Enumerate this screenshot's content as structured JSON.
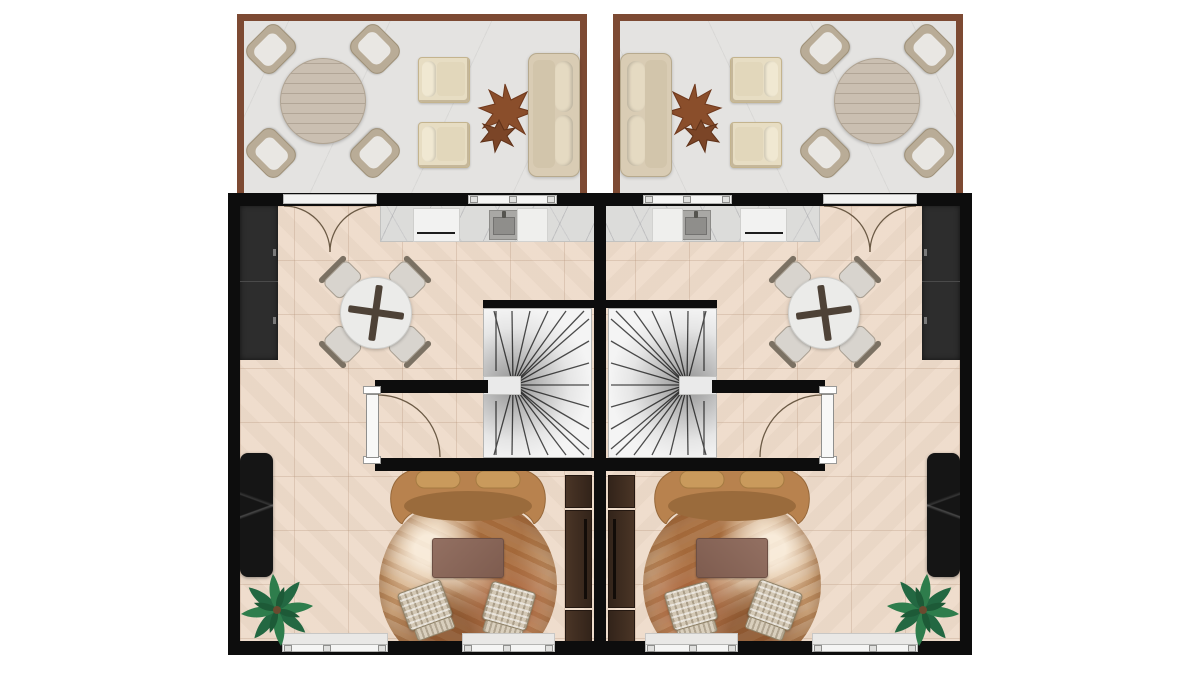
{
  "scene": {
    "type": "architectural-floor-plan",
    "view": "top-down 2D rendered plan",
    "description": "Two mirrored residential units (duplex) sharing a central party wall, each with a front terrace, kitchen-dining area, winder staircase and living room",
    "units": [
      "unit-left",
      "unit-right"
    ],
    "terraces": [
      "terrace-left",
      "terrace-right"
    ],
    "mirrored": true
  },
  "palette": {
    "background": "#ffffff",
    "wall": "#0d0d0d",
    "interior_floor_tile": "#eedbca",
    "terrace_floor": "#e4e3e1",
    "terrace_frame_wood": "#7d4a33",
    "marble_counter": "#dcdcda",
    "dark_wardrobe": "#2d2d2d",
    "black_marble_console": "#151515",
    "media_cabinet_wood": "#3a2a1e",
    "living_sofa_leather": "#b8824e",
    "sofa_cushion": "#c99a5c",
    "rug_base": "#c79d72",
    "rug_accent": "#8b4513",
    "coffee_table": "#8a665a",
    "ottoman_wicker": "#d3c8b5",
    "stair_tread": "#f4f4f4",
    "outdoor_table_wood": "#cabfb1",
    "outdoor_cream_upholstery": "#e7ddc3",
    "star_side_table_wood": "#8a4e2b",
    "plant_green": "#2e7d4c",
    "window_frame": "#f5f5f4",
    "door_swing_line": "#6b5a45"
  },
  "terrace": {
    "count": 2,
    "items": [
      {
        "name": "outdoor-dining-table",
        "qty": 1,
        "shape": "round wood"
      },
      {
        "name": "outdoor-dining-chair",
        "qty": 4,
        "style": "wicker with cushion"
      },
      {
        "name": "outdoor-armchair",
        "qty": 2,
        "style": "cream upholstered"
      },
      {
        "name": "star-side-table",
        "qty": 1,
        "style": "organic star-shaped wood"
      },
      {
        "name": "outdoor-sofa",
        "qty": 1,
        "style": "two-seat beige"
      }
    ]
  },
  "unit": {
    "count": 2,
    "rooms": [
      {
        "name": "kitchen-dining",
        "items": [
          {
            "name": "kitchen-counter",
            "qty": 1,
            "finish": "white marble"
          },
          {
            "name": "refrigerator",
            "qty": 1
          },
          {
            "name": "kitchen-sink",
            "qty": 1
          },
          {
            "name": "cooktop-module",
            "qty": 1
          },
          {
            "name": "wardrobe-cabinet",
            "qty": 1,
            "finish": "dark charcoal"
          },
          {
            "name": "round-dining-table",
            "qty": 1,
            "style": "glass top with cross base"
          },
          {
            "name": "dining-chair",
            "qty": 4
          },
          {
            "name": "french-double-door",
            "qty": 1,
            "leads_to": "terrace"
          }
        ]
      },
      {
        "name": "stair-hall",
        "items": [
          {
            "name": "winder-staircase",
            "qty": 1
          },
          {
            "name": "stair-landing",
            "qty": 1
          },
          {
            "name": "hall-door",
            "qty": 1,
            "swing": "quarter arc"
          }
        ]
      },
      {
        "name": "living-room",
        "items": [
          {
            "name": "curved-leather-sofa",
            "qty": 1
          },
          {
            "name": "round-area-rug",
            "qty": 1,
            "finish": "rust marble pattern"
          },
          {
            "name": "coffee-table",
            "qty": 1
          },
          {
            "name": "wicker-ottoman",
            "qty": 2
          },
          {
            "name": "media-cabinet",
            "qty": 1,
            "finish": "dark wood"
          },
          {
            "name": "black-marble-console",
            "qty": 1
          },
          {
            "name": "palm-plant",
            "qty": 1
          },
          {
            "name": "window",
            "qty": 2,
            "wall": "bottom"
          }
        ]
      }
    ]
  }
}
